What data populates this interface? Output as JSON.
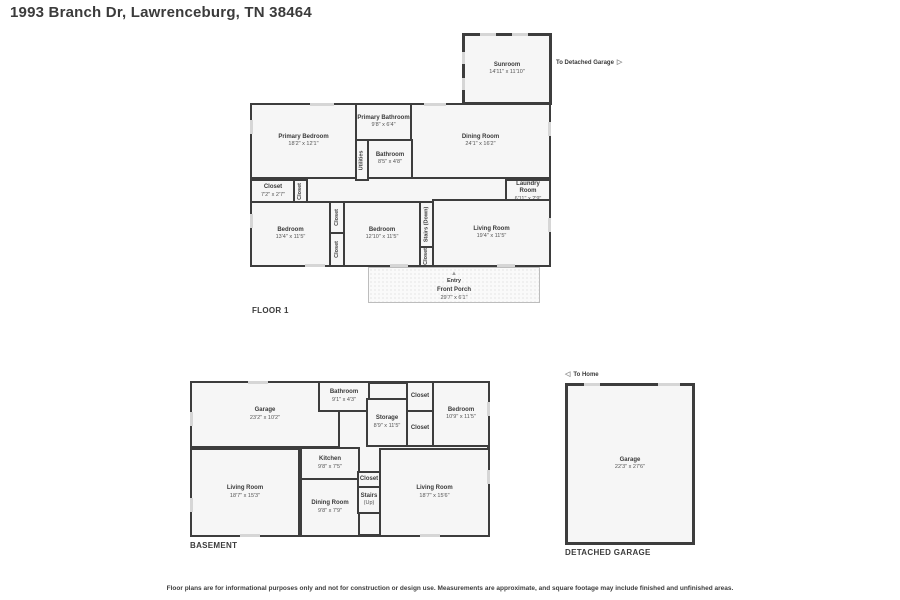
{
  "page": {
    "title": "1993 Branch Dr, Lawrenceburg, TN 38464",
    "disclaimer": "Floor plans are for informational purposes only and not for construction or design use. Measurements are approximate, and square footage may include finished and unfinished areas."
  },
  "colors": {
    "wall": "#3d3d3d",
    "room_fill": "#f6f6f6",
    "text": "#3b3b3b",
    "opening": "#d6d6d6"
  },
  "icons": {
    "to_garage_arrow": "▷",
    "to_home_arrow": "◁",
    "entry_arrow": "▲"
  },
  "floor1": {
    "label": "FLOOR 1",
    "to_garage": "To Detached Garage",
    "entry": "Entry",
    "rooms": {
      "sunroom": {
        "name": "Sunroom",
        "dims": "14'11\" x 11'10\""
      },
      "primary_bedroom": {
        "name": "Primary Bedroom",
        "dims": "18'2\" x 12'1\""
      },
      "primary_bathroom": {
        "name": "Primary Bathroom",
        "dims": "9'8\" x 6'4\""
      },
      "utilities": {
        "name": "Utilities"
      },
      "bathroom": {
        "name": "Bathroom",
        "dims": "8'5\" x 4'8\""
      },
      "dining_room": {
        "name": "Dining Room",
        "dims": "24'1\" x 16'2\""
      },
      "laundry_room": {
        "name": "Laundry Room",
        "dims": "6'11\" x 2'9\""
      },
      "closet_a": {
        "name": "Closet",
        "dims": "7'2\" x 2'7\""
      },
      "closet_b": {
        "name": "Closet"
      },
      "bedroom_left": {
        "name": "Bedroom",
        "dims": "13'4\" x 11'5\""
      },
      "closet_c": {
        "name": "Closet"
      },
      "closet_d": {
        "name": "Closet"
      },
      "bedroom_right": {
        "name": "Bedroom",
        "dims": "12'10\" x 11'5\""
      },
      "stairs_down": {
        "name": "Stairs (Down)"
      },
      "closet_e": {
        "name": "Closet"
      },
      "living_room": {
        "name": "Living Room",
        "dims": "19'4\" x 11'5\""
      },
      "front_porch": {
        "name": "Front Porch",
        "dims": "29'7\" x 6'1\""
      }
    }
  },
  "basement": {
    "label": "BASEMENT",
    "rooms": {
      "garage": {
        "name": "Garage",
        "dims": "23'2\" x 10'2\""
      },
      "bathroom": {
        "name": "Bathroom",
        "dims": "9'1\" x 4'3\""
      },
      "storage": {
        "name": "Storage",
        "dims": "8'9\" x 11'5\""
      },
      "closet_a": {
        "name": "Closet"
      },
      "closet_b": {
        "name": "Closet"
      },
      "bedroom": {
        "name": "Bedroom",
        "dims": "10'9\" x 11'5\""
      },
      "kitchen": {
        "name": "Kitchen",
        "dims": "9'8\" x 7'5\""
      },
      "living_room_left": {
        "name": "Living Room",
        "dims": "18'7\" x 15'3\""
      },
      "dining_room": {
        "name": "Dining Room",
        "dims": "9'8\" x 7'9\""
      },
      "closet_c": {
        "name": "Closet"
      },
      "stairs_up": {
        "name": "Stairs",
        "dims": "(Up)"
      },
      "living_room_right": {
        "name": "Living Room",
        "dims": "18'7\" x 15'6\""
      }
    }
  },
  "detached_garage": {
    "label": "DETACHED GARAGE",
    "to_home": "To Home",
    "rooms": {
      "garage": {
        "name": "Garage",
        "dims": "22'3\" x 27'6\""
      }
    }
  }
}
